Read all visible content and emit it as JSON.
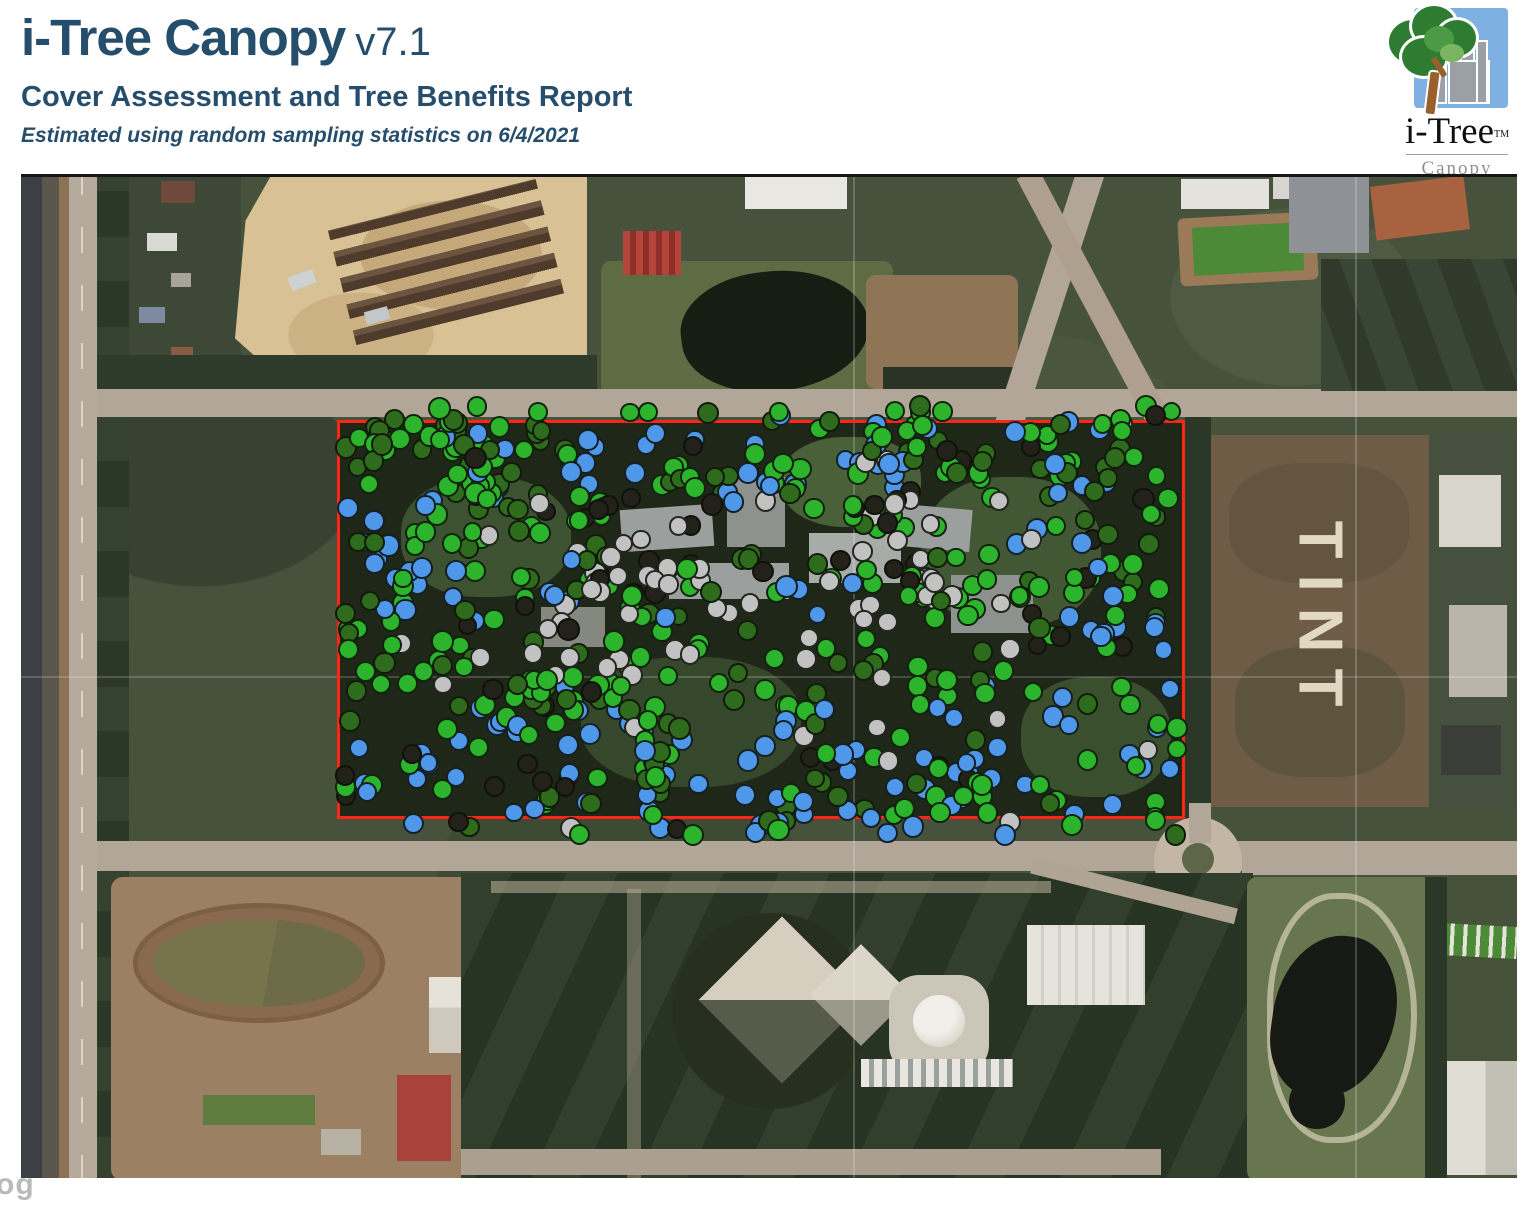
{
  "header": {
    "app_title": "i-Tree Canopy",
    "app_version": "v7.1",
    "report_title": "Cover Assessment and Tree Benefits Report",
    "report_subtitle": "Estimated using random sampling statistics on 6/4/2021",
    "text_color": "#254d6c"
  },
  "logo": {
    "brand": "i-Tree",
    "tm": "TM",
    "product": "Canopy",
    "sky_color": "#7fb0e2",
    "city_color": "#9aa0a5",
    "tree_color": "#2e7c31",
    "trunk_color": "#9a5f2b"
  },
  "map": {
    "tint_field_label": "TINT",
    "google_watermark_fragment": "og",
    "study_area": {
      "border_color": "#ff2517",
      "rect_px": {
        "left": 316,
        "top": 243,
        "width": 848,
        "height": 399
      }
    },
    "sample_points": {
      "total": 680,
      "seed": 1337,
      "diameter_px": 21,
      "outline_color": "#15190f",
      "classes": [
        {
          "name": "green",
          "color": "#2db42d"
        },
        {
          "name": "dark-green",
          "color": "#2e6b1c"
        },
        {
          "name": "blue",
          "color": "#4f97e8"
        },
        {
          "name": "gray",
          "color": "#c2c2c2"
        },
        {
          "name": "black",
          "color": "#22211a"
        }
      ],
      "zones": [
        {
          "name": "top-band-blue",
          "u": [
            0.27,
            1.01
          ],
          "v": [
            -0.06,
            0.18
          ],
          "weights": {
            "green": 0.34,
            "blue": 0.33,
            "dark-green": 0.21,
            "black": 0.08,
            "gray": 0.04
          }
        },
        {
          "name": "top-band-left",
          "u": [
            -0.01,
            0.27
          ],
          "v": [
            -0.06,
            0.2
          ],
          "weights": {
            "green": 0.48,
            "dark-green": 0.28,
            "blue": 0.14,
            "black": 0.1
          }
        },
        {
          "name": "left-blue-pocket",
          "u": [
            -0.01,
            0.13
          ],
          "v": [
            0.2,
            0.48
          ],
          "weights": {
            "blue": 0.44,
            "green": 0.34,
            "dark-green": 0.16,
            "black": 0.06
          }
        },
        {
          "name": "center-impervious",
          "u": [
            0.22,
            0.8
          ],
          "v": [
            0.2,
            0.64
          ],
          "weights": {
            "gray": 0.37,
            "green": 0.27,
            "black": 0.17,
            "dark-green": 0.14,
            "blue": 0.05
          }
        },
        {
          "name": "bottom-band-blue",
          "u": [
            -0.01,
            1.01
          ],
          "v": [
            0.72,
            1.06
          ],
          "weights": {
            "blue": 0.43,
            "green": 0.33,
            "dark-green": 0.12,
            "black": 0.08,
            "gray": 0.04
          }
        },
        {
          "name": "right-column",
          "u": [
            0.86,
            1.01
          ],
          "v": [
            0.14,
            0.76
          ],
          "weights": {
            "blue": 0.4,
            "green": 0.3,
            "dark-green": 0.24,
            "black": 0.06
          }
        },
        {
          "name": "default",
          "weights": {
            "green": 0.5,
            "dark-green": 0.26,
            "blue": 0.1,
            "black": 0.09,
            "gray": 0.05
          }
        }
      ]
    }
  }
}
